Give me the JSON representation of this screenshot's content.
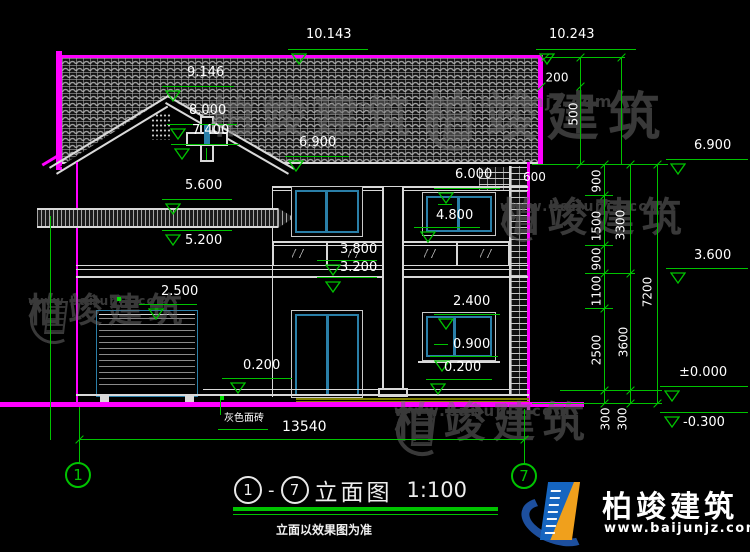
{
  "drawing": {
    "title": {
      "axis_from": "1",
      "axis_to": "7",
      "dash": "-",
      "name": "立面图",
      "scale": "1:100",
      "note": "立面以效果图为准"
    },
    "axis_bubbles": {
      "left": "1",
      "right": "7"
    },
    "watermark": {
      "brand": "柏竣建筑",
      "url": "www.baijunjz.com"
    },
    "brand_logo": {
      "brand": "柏竣建筑",
      "url": "www.baijunjz.com"
    }
  },
  "colors": {
    "background": "#000000",
    "dimension_green": "#00c300",
    "outline_magenta": "#ff00ff",
    "window_teal": "#2a7fa8",
    "line_white": "#d9d9d9",
    "plinth_olive": "#808000",
    "watermark_gray": "#6e6e6e",
    "logo_blue": "#1565c0",
    "logo_orange": "#f0a01c",
    "logo_navy": "#1d4f9e"
  },
  "levels": [
    {
      "label": "10.143",
      "tx": 306,
      "ty": 28,
      "lx": 288,
      "ly": 49,
      "lw": 80,
      "trix": 291
    },
    {
      "label": "10.243",
      "tx": 549,
      "ty": 28,
      "lx": 536,
      "ly": 49,
      "lw": 100,
      "trix": 539
    },
    {
      "label": "9.146",
      "tx": 187,
      "ty": 66,
      "lx": 162,
      "ly": 86,
      "lw": 72,
      "trix": 165
    },
    {
      "label": "8.000",
      "tx": 189,
      "ty": 104,
      "lx": 167,
      "ly": 124,
      "lw": 70,
      "trix": 170
    },
    {
      "label": "7.400",
      "tx": 192,
      "ty": 124,
      "lx": 171,
      "ly": 144,
      "lw": 68,
      "trix": 174
    },
    {
      "label": "6.900",
      "tx": 299,
      "ty": 136,
      "lx": 285,
      "ly": 156,
      "lw": 64,
      "trix": 288
    },
    {
      "label": "5.600",
      "tx": 185,
      "ty": 179,
      "lx": 162,
      "ly": 199,
      "lw": 70,
      "trix": 165
    },
    {
      "label": "5.200",
      "tx": 185,
      "ty": 234,
      "lx": 162,
      "ly": 230,
      "lw": 70,
      "trix": 165
    },
    {
      "label": "2.500",
      "tx": 161,
      "ty": 285,
      "lx": 139,
      "ly": 304,
      "lw": 58,
      "trix": 148
    },
    {
      "label": "0.200",
      "tx": 243,
      "ty": 359,
      "lx": 222,
      "ly": 378,
      "lw": 70,
      "trix": 230
    },
    {
      "label": "6.000",
      "tx": 455,
      "ty": 168,
      "lx": 434,
      "ly": 188,
      "lw": 66,
      "trix": 438
    },
    {
      "label": "4.800",
      "tx": 436,
      "ty": 209,
      "lx": 414,
      "ly": 227,
      "lw": 66,
      "trix": 420
    },
    {
      "label": "3.800",
      "tx": 340,
      "ty": 243,
      "lx": 317,
      "ly": 260,
      "lw": 60,
      "trix": 325
    },
    {
      "label": "3.200",
      "tx": 340,
      "ty": 261,
      "lx": 317,
      "ly": 277,
      "lw": 60,
      "trix": 325
    },
    {
      "label": "2.400",
      "tx": 453,
      "ty": 295,
      "lx": 434,
      "ly": 314,
      "lw": 66,
      "trix": 438
    },
    {
      "label": "0.900",
      "tx": 453,
      "ty": 338,
      "lx": 430,
      "ly": 356,
      "lw": 68,
      "trix": 434
    },
    {
      "label": "0.200",
      "tx": 444,
      "ty": 361,
      "lx": 426,
      "ly": 379,
      "lw": 66,
      "trix": 430
    },
    {
      "label": "6.900",
      "tx": 694,
      "ty": 139,
      "lx": 666,
      "ly": 159,
      "lw": 82,
      "trix": 670
    },
    {
      "label": "3.600",
      "tx": 694,
      "ty": 249,
      "lx": 666,
      "ly": 268,
      "lw": 82,
      "trix": 670
    },
    {
      "label": "±0.000",
      "tx": 679,
      "ty": 366,
      "lx": 660,
      "ly": 386,
      "lw": 88,
      "trix": 664
    },
    {
      "label": "-0.300",
      "tx": 683,
      "ty": 416,
      "lx": 660,
      "ly": 412,
      "lw": 88,
      "trix": 664
    }
  ],
  "chains": [
    {
      "x": 580,
      "y1": 57,
      "y2": 164,
      "boundaries": [
        57,
        86,
        164
      ],
      "labels": [
        {
          "t": "200",
          "cx": 557,
          "cy": 78,
          "rot": 0
        },
        {
          "t": "500",
          "cx": 574,
          "cy": 114,
          "rot": 1
        }
      ]
    },
    {
      "x": 604,
      "y1": 164,
      "y2": 403,
      "boundaries": [
        164,
        195,
        245,
        273,
        308,
        390,
        403
      ],
      "labels": [
        {
          "t": "900",
          "cx": 597,
          "cy": 181,
          "rot": 1
        },
        {
          "t": "1500",
          "cx": 597,
          "cy": 226,
          "rot": 1
        },
        {
          "t": "900",
          "cx": 597,
          "cy": 259,
          "rot": 1
        },
        {
          "t": "1100",
          "cx": 597,
          "cy": 291,
          "rot": 1
        },
        {
          "t": "2500",
          "cx": 597,
          "cy": 350,
          "rot": 1
        },
        {
          "t": "300",
          "cx": 606,
          "cy": 419,
          "rot": 1
        }
      ]
    },
    {
      "x": 630,
      "y1": 164,
      "y2": 403,
      "boundaries": [
        164,
        273,
        390,
        403
      ],
      "labels": [
        {
          "t": "3300",
          "cx": 621,
          "cy": 225,
          "rot": 1
        },
        {
          "t": "3600",
          "cx": 624,
          "cy": 342,
          "rot": 1
        },
        {
          "t": "300",
          "cx": 623,
          "cy": 419,
          "rot": 1
        }
      ]
    },
    {
      "x": 657,
      "y1": 164,
      "y2": 403,
      "boundaries": [
        164,
        403
      ],
      "labels": [
        {
          "t": "7200",
          "cx": 648,
          "cy": 292,
          "rot": 1
        }
      ]
    }
  ],
  "green_segments": [
    {
      "x": 545,
      "y": 57,
      "w": 80,
      "h": 1
    },
    {
      "x": 621,
      "y": 57,
      "w": 1,
      "h": 107
    },
    {
      "x": 532,
      "y": 164,
      "w": 136,
      "h": 1
    },
    {
      "x": 585,
      "y": 195,
      "w": 28,
      "h": 1
    },
    {
      "x": 585,
      "y": 245,
      "w": 28,
      "h": 1
    },
    {
      "x": 585,
      "y": 273,
      "w": 50,
      "h": 1
    },
    {
      "x": 585,
      "y": 308,
      "w": 28,
      "h": 1
    },
    {
      "x": 560,
      "y": 390,
      "w": 102,
      "h": 1
    },
    {
      "x": 532,
      "y": 403,
      "w": 130,
      "h": 1
    },
    {
      "x": 220,
      "y": 398,
      "w": 1,
      "h": 17
    },
    {
      "x": 218,
      "y": 429,
      "w": 50,
      "h": 1
    },
    {
      "x": 206,
      "y": 148,
      "w": 1,
      "h": 12
    },
    {
      "x": 438,
      "y": 204,
      "w": 14,
      "h": 1
    },
    {
      "x": 434,
      "y": 344,
      "w": 14,
      "h": 1
    },
    {
      "x": 50,
      "y": 216,
      "w": 1,
      "h": 224
    },
    {
      "x": 79,
      "y": 407,
      "w": 1,
      "h": 56
    },
    {
      "x": 524,
      "y": 409,
      "w": 1,
      "h": 55
    },
    {
      "x": 79,
      "y": 439,
      "w": 446,
      "h": 1
    }
  ],
  "loose_ticks": [
    {
      "x": 79,
      "y": 439
    },
    {
      "x": 524,
      "y": 439
    },
    {
      "x": 541,
      "y": 86
    },
    {
      "x": 545,
      "y": 57
    },
    {
      "x": 621,
      "y": 57
    }
  ],
  "green_dots": [
    {
      "x": 117,
      "y": 297
    },
    {
      "x": 220,
      "y": 396
    }
  ],
  "free_texts": [
    {
      "t": "600",
      "x": 523,
      "y": 171,
      "s": 12,
      "n": "dim-text-600"
    },
    {
      "t": "13540",
      "x": 282,
      "y": 420,
      "s": 14,
      "n": "dim-text-overall-width"
    },
    {
      "t": "灰色面砖",
      "x": 224,
      "y": 413,
      "s": 10,
      "n": "material-label-gray-brick"
    }
  ],
  "watermarks": [
    {
      "x": 210,
      "y": 96,
      "fs": 44,
      "us": 15,
      "ls": 0
    },
    {
      "x": 424,
      "y": 92,
      "fs": 52,
      "us": 16,
      "ls": 62
    },
    {
      "x": 28,
      "y": 294,
      "fs": 34,
      "us": 12,
      "ls": 52
    },
    {
      "x": 500,
      "y": 198,
      "fs": 40,
      "us": 14,
      "ls": 46
    },
    {
      "x": 394,
      "y": 402,
      "fs": 42,
      "us": 15,
      "ls": 56
    }
  ]
}
